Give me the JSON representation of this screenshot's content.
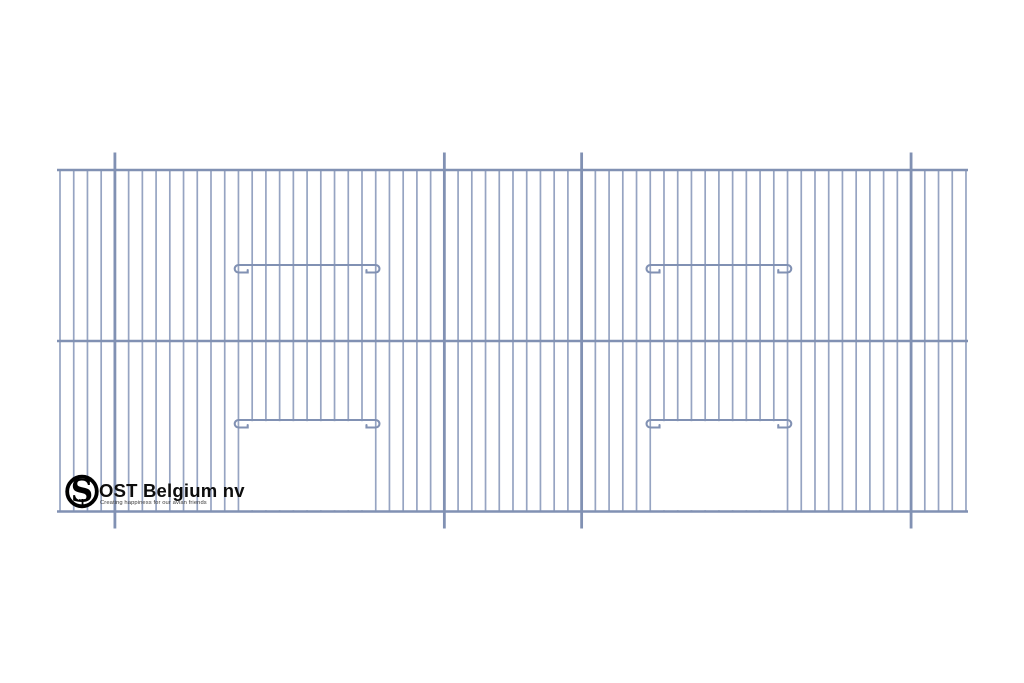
{
  "page": {
    "background": "#ffffff"
  },
  "drawing": {
    "description": "wire cage front panel",
    "wire_color": "#96a4c2",
    "frame_color": "#8191b3",
    "opening_color": "#ffffff",
    "panel": {
      "left": 57,
      "right": 968,
      "top": 170,
      "middle": 341,
      "bottom": 511.5
    },
    "wires": {
      "first_x": 60,
      "pitch": 13.727,
      "count": 67,
      "stroke": 1.7
    },
    "posts": {
      "indices": [
        4,
        28,
        38,
        62
      ],
      "extend_top": 152.5,
      "extend_bottom": 528.5,
      "stroke": 2.8
    },
    "hooks": {
      "curl_radius": 3.75,
      "tail": 13,
      "tick": 2.5,
      "top_y": 265,
      "door_y": 420,
      "stroke": 2.1
    },
    "doors": [
      {
        "left_wire": 13,
        "right_wire": 23
      },
      {
        "left_wire": 43,
        "right_wire": 53
      }
    ]
  },
  "logo": {
    "title": "OST Belgium nv",
    "tagline": "Creating happiness for our avian friends",
    "monogram": "S",
    "monogram_sub": "T",
    "ring_color": "#000000",
    "title_color": "#0d0d0d",
    "tagline_color": "#3a3a3a"
  }
}
